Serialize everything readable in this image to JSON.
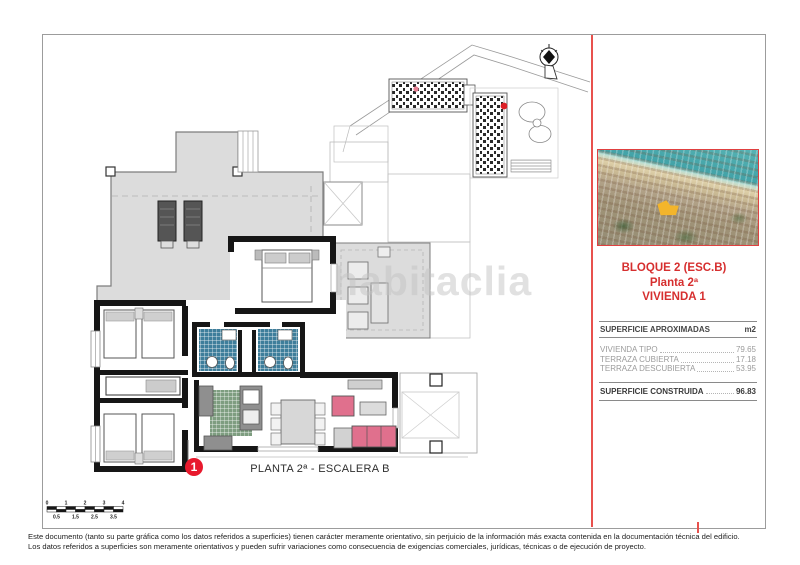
{
  "watermark": "habitaclia",
  "plan": {
    "caption": "PLANTA 2ª - ESCALERA B",
    "marker_label": "1",
    "scale_top": [
      "0",
      "1",
      "2",
      "3",
      "4"
    ],
    "scale_bottom": [
      "0.5",
      "1.5",
      "2.5",
      "3.5"
    ]
  },
  "info_panel": {
    "title_line1": "BLOQUE 2 (ESC.B)",
    "title_line2": "Planta 2ª",
    "title_line3": "VIVIENDA 1",
    "table": {
      "header": "SUPERFICIE APROXIMADAS",
      "unit": "m2",
      "rows": [
        {
          "label": "VIVIENDA TIPO",
          "value": "79.65"
        },
        {
          "label": "TERRAZA CUBIERTA",
          "value": "17.18"
        },
        {
          "label": "TERRAZA DESCUBIERTA",
          "value": "53.95"
        }
      ],
      "total": {
        "label": "SUPERFICIE CONSTRUIDA",
        "value": "96.83"
      }
    }
  },
  "footer": {
    "line1": "Este documento (tanto su parte gráfica como los datos referidos a superficies) tienen carácter meramente orientativo, sin perjuicio de la información más exacta contenida en la documentación técnica del edificio.",
    "line2": "Los datos referidos a superficies son meramente orientativos y pueden sufrir variaciones como consecuencia de exigencias comerciales, jurídicas, técnicas o de ejecución de proyecto."
  },
  "colors": {
    "accent_red": "#d62f2f",
    "separator_red": "#e8514d",
    "marker_red": "#e8192d",
    "highlight_yellow": "#f3b52b",
    "terrace_gray": "#dcdcdc",
    "bath_tile_blue": "#3e7e9b",
    "kitchen_tile_green": "#7e9d80",
    "sofa_pink": "#e0708d"
  }
}
